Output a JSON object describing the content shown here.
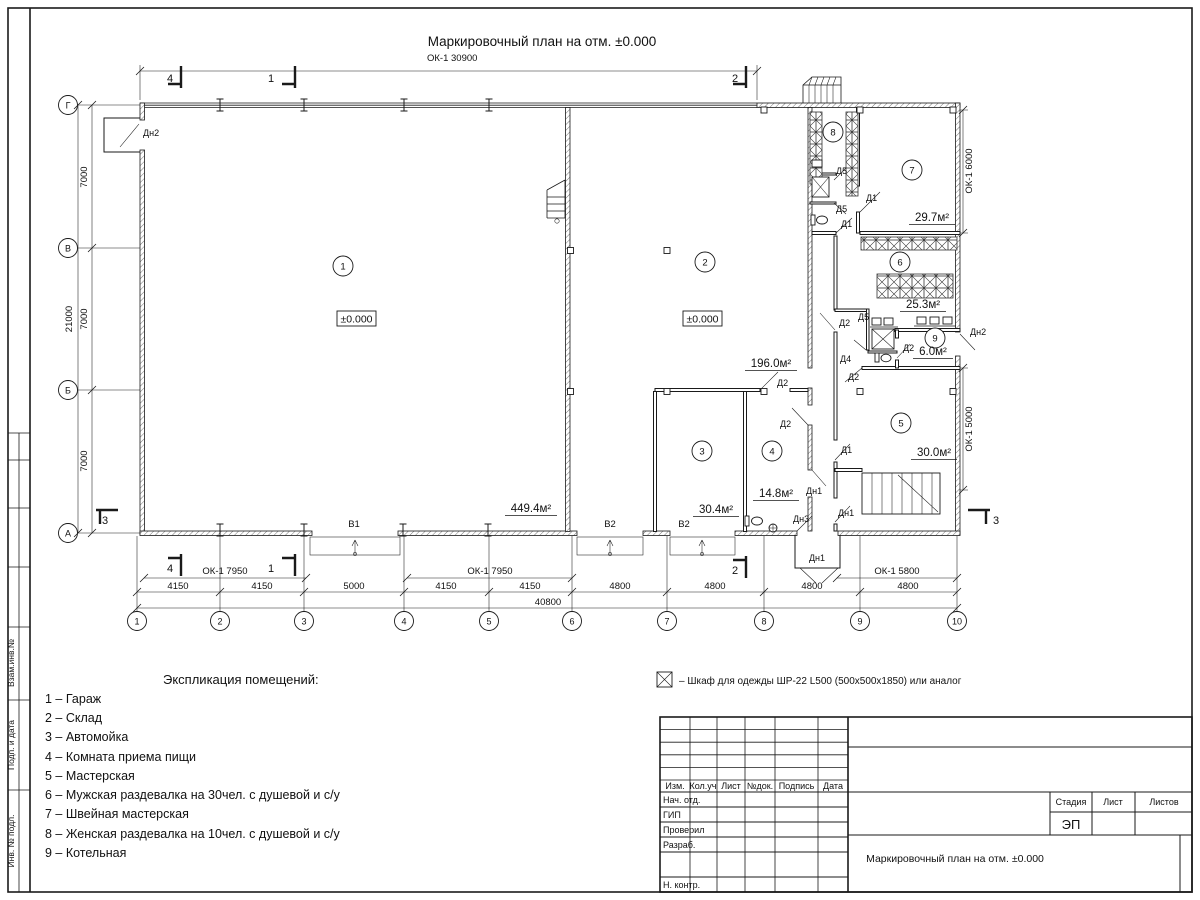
{
  "sheet": {
    "plan_title": "Маркировочный план на отм. ±0.000"
  },
  "plan": {
    "dims": {
      "top": "ОК-1 30900",
      "bottom": [
        "4150",
        "4150",
        "5000",
        "4150",
        "4150",
        "4800",
        "4800",
        "4800",
        "4800"
      ],
      "total": "40800",
      "windows_bottom": [
        "ОК-1 7950",
        "ОК-1 7950",
        "ОК-1 5800"
      ],
      "left": [
        "7000",
        "7000",
        "7000"
      ],
      "left_total": "21000",
      "right": [
        "ОК-1 6000",
        "ОК-1 5000"
      ]
    },
    "axis_cols": [
      "1",
      "2",
      "3",
      "4",
      "5",
      "6",
      "7",
      "8",
      "9",
      "10"
    ],
    "axis_rows": [
      "Г",
      "В",
      "Б",
      "А"
    ],
    "sections": {
      "one": "1",
      "two": "2",
      "three": "3",
      "four": "4"
    },
    "rooms": [
      "1",
      "2",
      "3",
      "4",
      "5",
      "6",
      "7",
      "8",
      "9"
    ],
    "areas": [
      "449.4м²",
      "196.0м²",
      "30.4м²",
      "14.8м²",
      "30.0м²",
      "25.3м²",
      "6.0м²",
      "29.7м²"
    ],
    "elevations": [
      "±0.000",
      "±0.000"
    ],
    "doors": [
      "Дн2",
      "Д5",
      "Д1",
      "Д5",
      "Д1",
      "Д2",
      "Д5",
      "Д2",
      "Д4",
      "Дн2",
      "Д2",
      "Д2",
      "Д2",
      "Д1",
      "Дн1",
      "Дн1",
      "Дн3",
      "Дн1"
    ],
    "gates": [
      "В1",
      "В2",
      "В2"
    ]
  },
  "legend": {
    "title": "Экспликация помещений:",
    "items": [
      "1 – Гараж",
      "2 – Склад",
      "3 – Автомойка",
      "4 – Комната приема пищи",
      "5 – Мастерская",
      "6 – Мужская раздевалка на 30чел. с душевой и с/у",
      "7 – Швейная мастерская",
      "8 – Женская раздевалка на 10чел. с душевой и с/у",
      "9 – Котельная"
    ]
  },
  "note": {
    "text": "–  Шкаф для одежды ШР-22 L500 (500x500x1850) или аналог"
  },
  "titleblock": {
    "header_cols": [
      "Изм.",
      "Кол.уч",
      "Лист",
      "№док.",
      "Подпись",
      "Дата"
    ],
    "rows": [
      "Нач. отд.",
      "ГИП",
      "Проверил",
      "Разраб.",
      "Н. контр."
    ],
    "stage_headers": [
      "Стадия",
      "Лист",
      "Листов"
    ],
    "stage_value": "ЭП",
    "doc_title": "Маркировочный план на отм. ±0.000"
  },
  "margin_labels": [
    "Взам.инв.№",
    "Подп. и дата",
    "Инв. № подл."
  ]
}
